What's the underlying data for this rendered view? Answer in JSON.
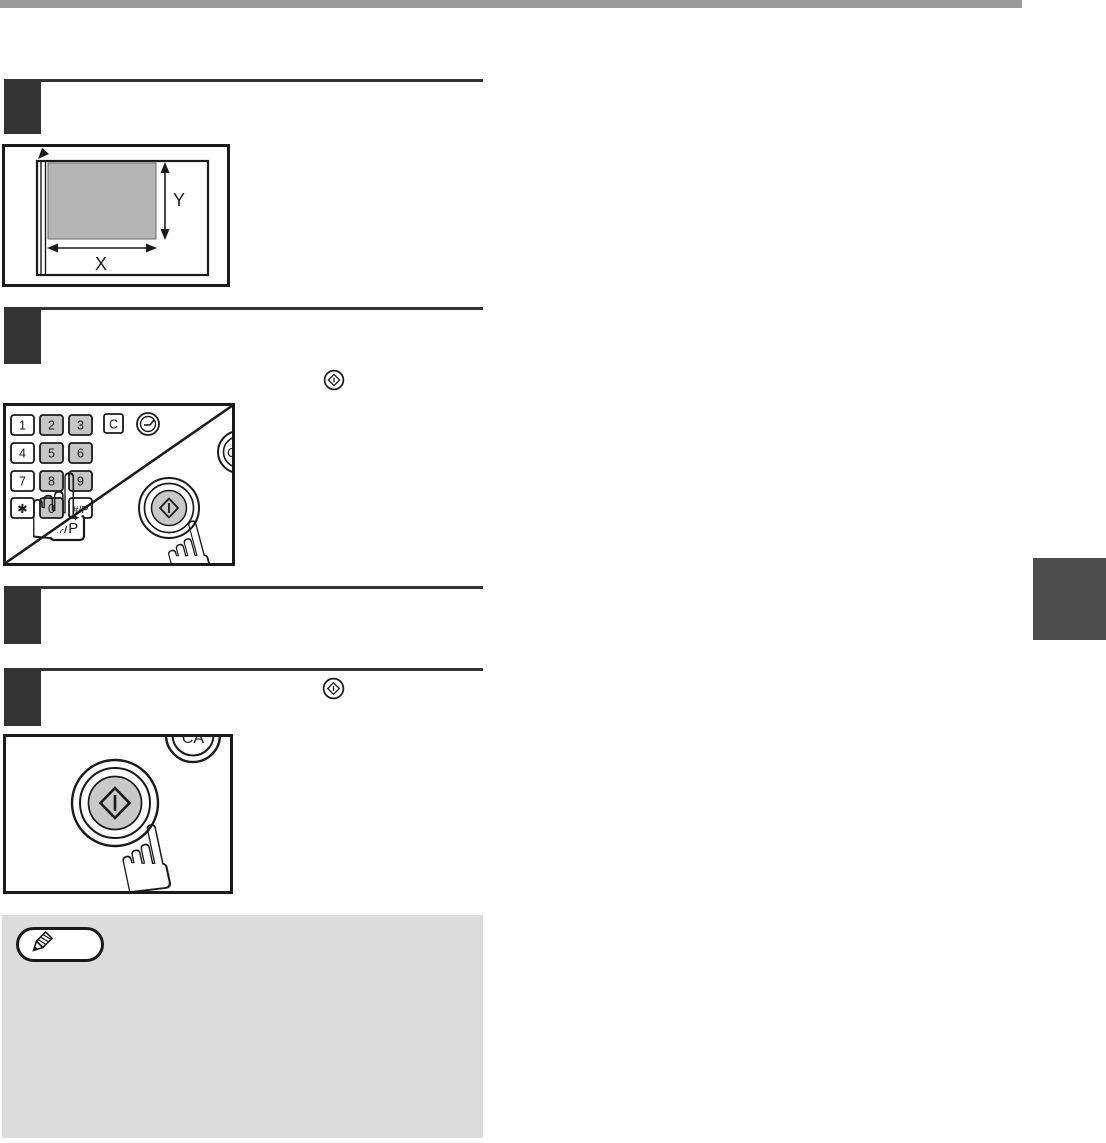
{
  "page": {
    "type": "copier-manual-page",
    "colors": {
      "top_bar": "#9b9b9b",
      "step_marker": "#333333",
      "side_tab": "#4d4d4d",
      "note_background": "#dcdcdc",
      "key_gray": "#c6c6c6",
      "document_gray": "#b5b5b5",
      "start_key_gray": "#c9c9c9",
      "line_ink": "#1a1a1a"
    }
  },
  "platen_illustration": {
    "y_label": "Y",
    "x_label": "X"
  },
  "keypad": {
    "rows": [
      [
        "1",
        "2",
        "3"
      ],
      [
        "4",
        "5",
        "6"
      ],
      [
        "7",
        "8",
        "9"
      ],
      [
        "✱",
        "0",
        "#/P"
      ]
    ],
    "clear_key": "C",
    "clear_all_key": "CA",
    "program_key_large": "#/P"
  },
  "start_illustration": {
    "clear_all_key": "CA"
  },
  "icons": {
    "start_key": "circled diamond start symbol",
    "audit_clear_key": "circled dial symbol",
    "pointing_hand": "☝",
    "note_pencil": "pencil",
    "alignment_mark": "solid corner arrow"
  }
}
